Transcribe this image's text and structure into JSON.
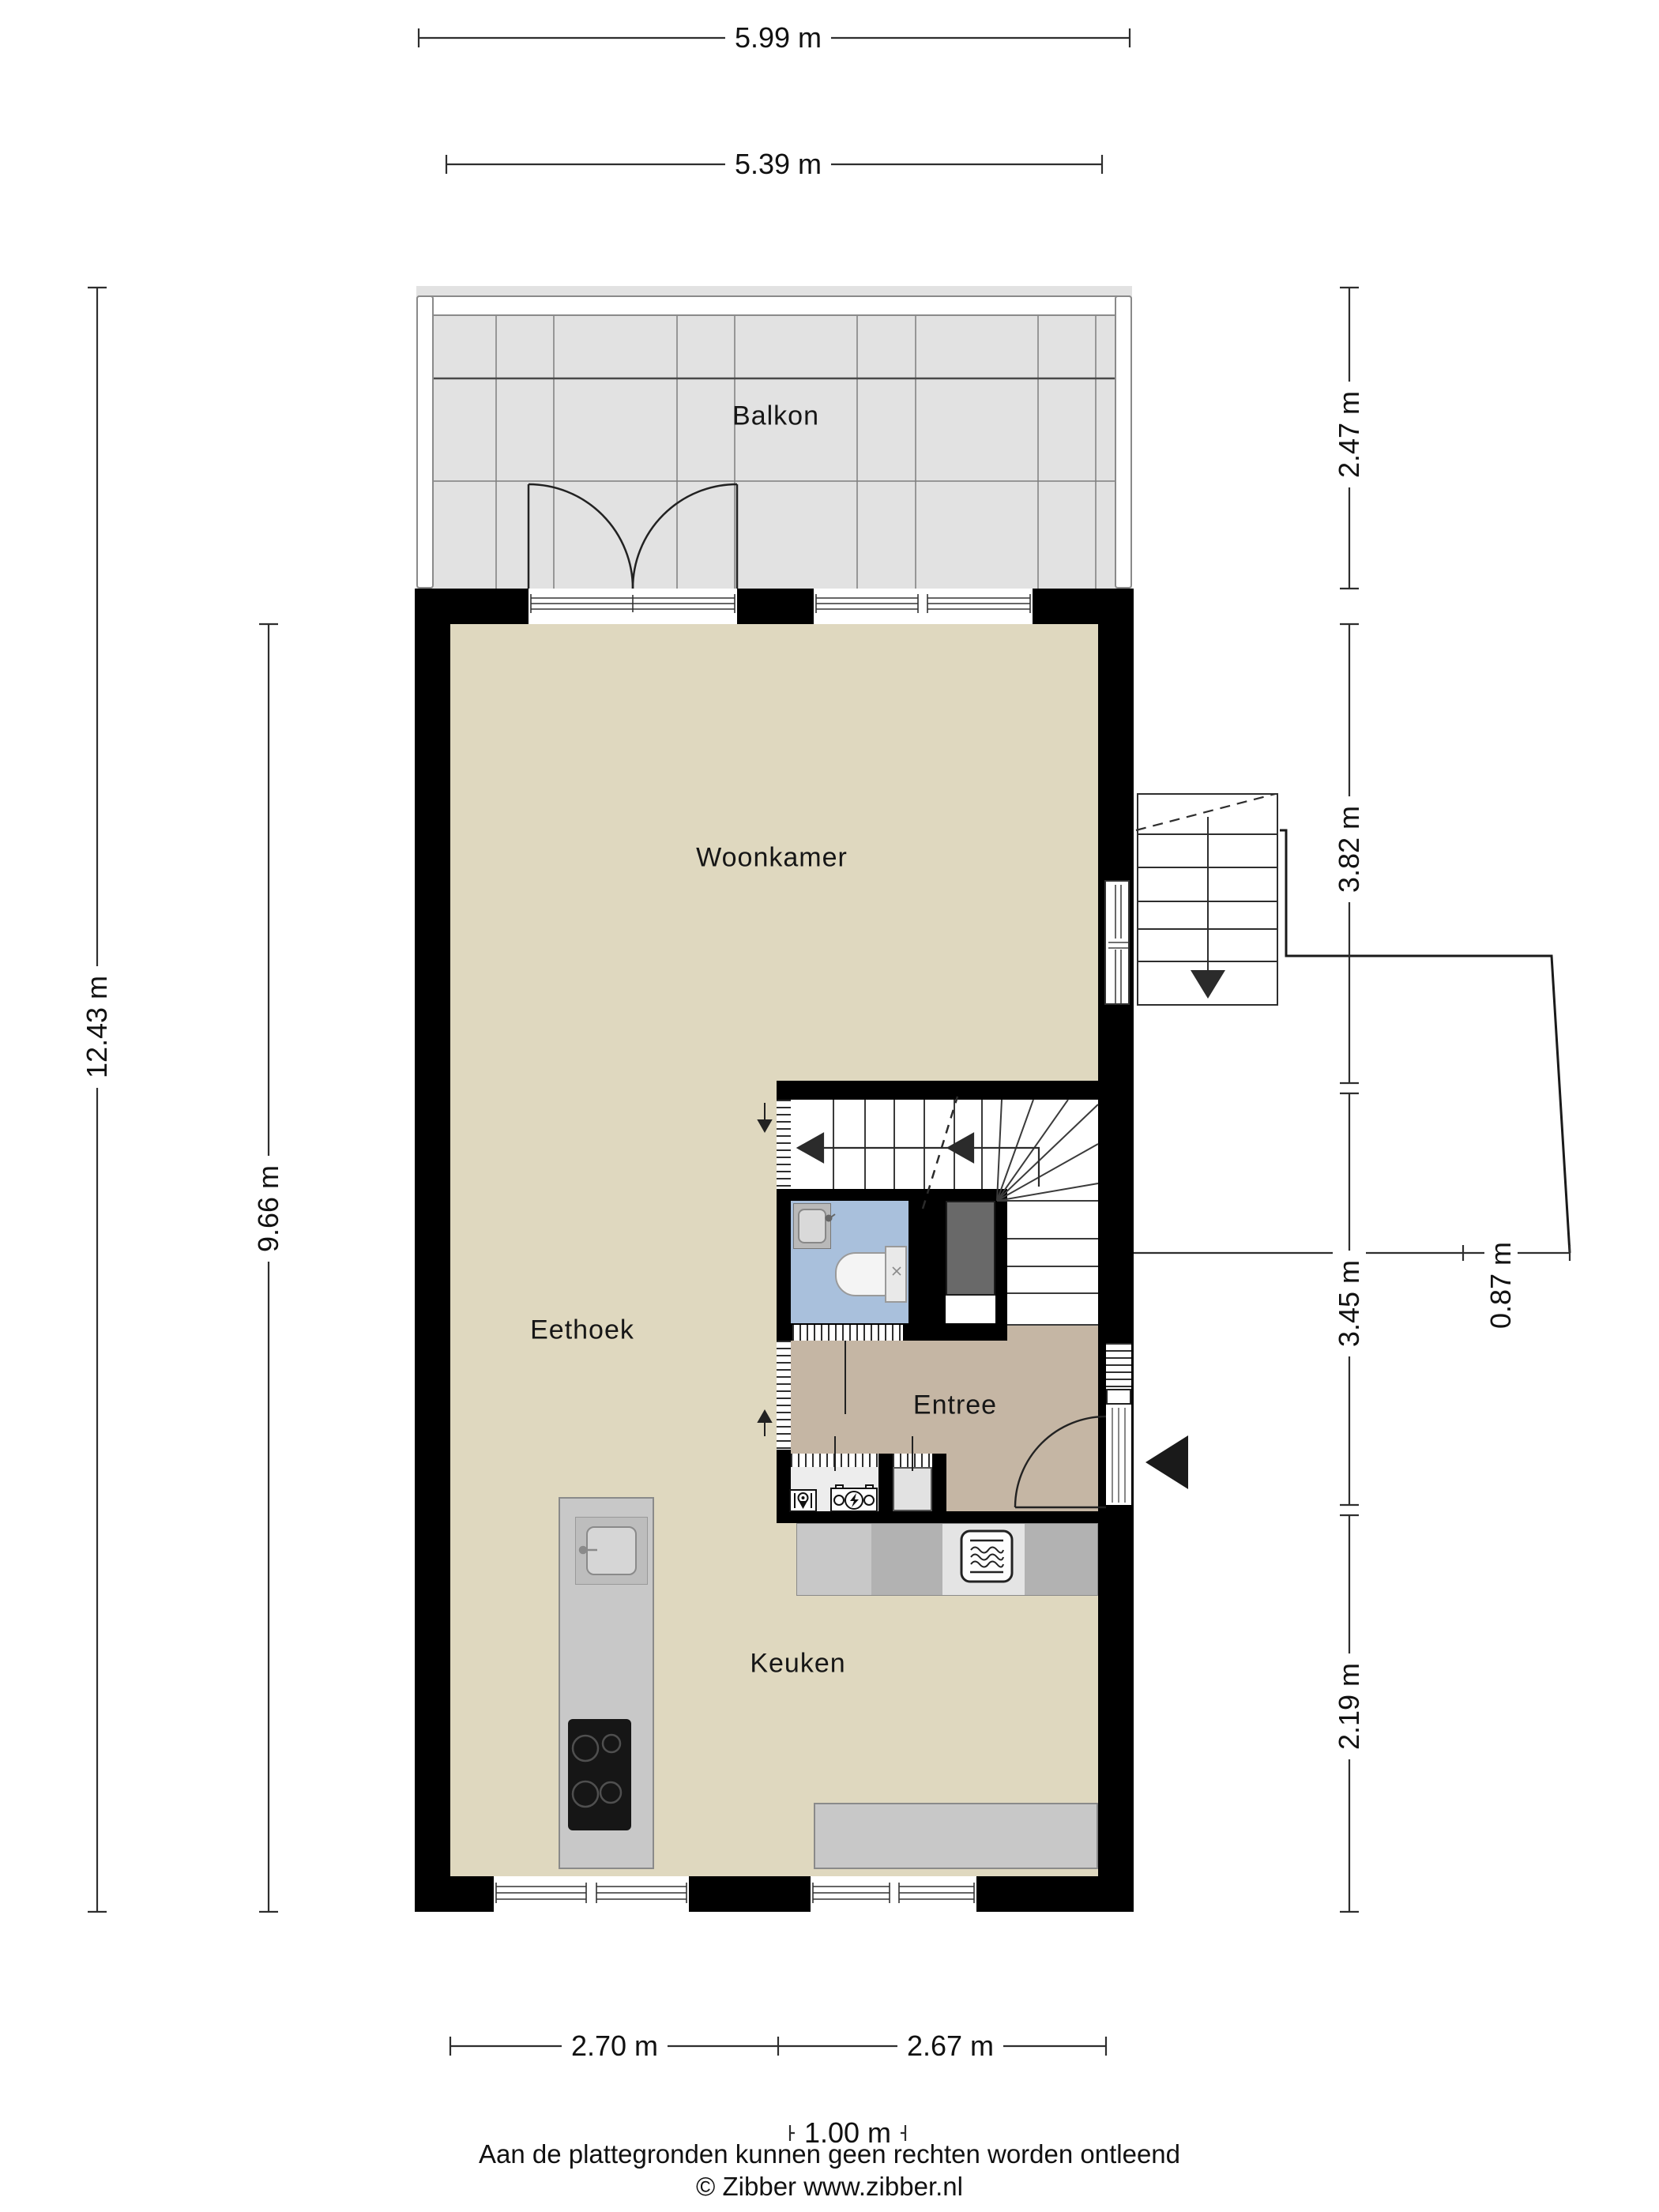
{
  "rooms": {
    "balkon": "Balkon",
    "woonkamer": "Woonkamer",
    "eethoek": "Eethoek",
    "entree": "Entree",
    "keuken": "Keuken"
  },
  "dims": {
    "top_outer": "5.99 m",
    "top_inner": "5.39 m",
    "left_outer": "12.43 m",
    "left_inner": "9.66 m",
    "right_balcony": "2.47 m",
    "right_living": "3.82 m",
    "right_hall": "3.45 m",
    "right_kitchen": "2.19 m",
    "entry_landing": "0.87 m",
    "bottom_left": "2.70 m",
    "bottom_right": "2.67 m",
    "bottom_scale": "1.00 m"
  },
  "footer": {
    "disclaimer": "Aan de plattegronden kunnen geen rechten worden ontleend",
    "copyright": "© Zibber www.zibber.nl"
  },
  "colors": {
    "wall": "#000000",
    "floor": "#dfd8bf",
    "entree_floor": "#c5b6a4",
    "bathroom_floor": "#a9c0dc",
    "balcony_floor": "#e2e2e2",
    "closet_fill": "#696969",
    "counter_light": "#c8c8c8",
    "counter_mid": "#b2b2b2",
    "counter_bright": "#e4e4e4"
  }
}
